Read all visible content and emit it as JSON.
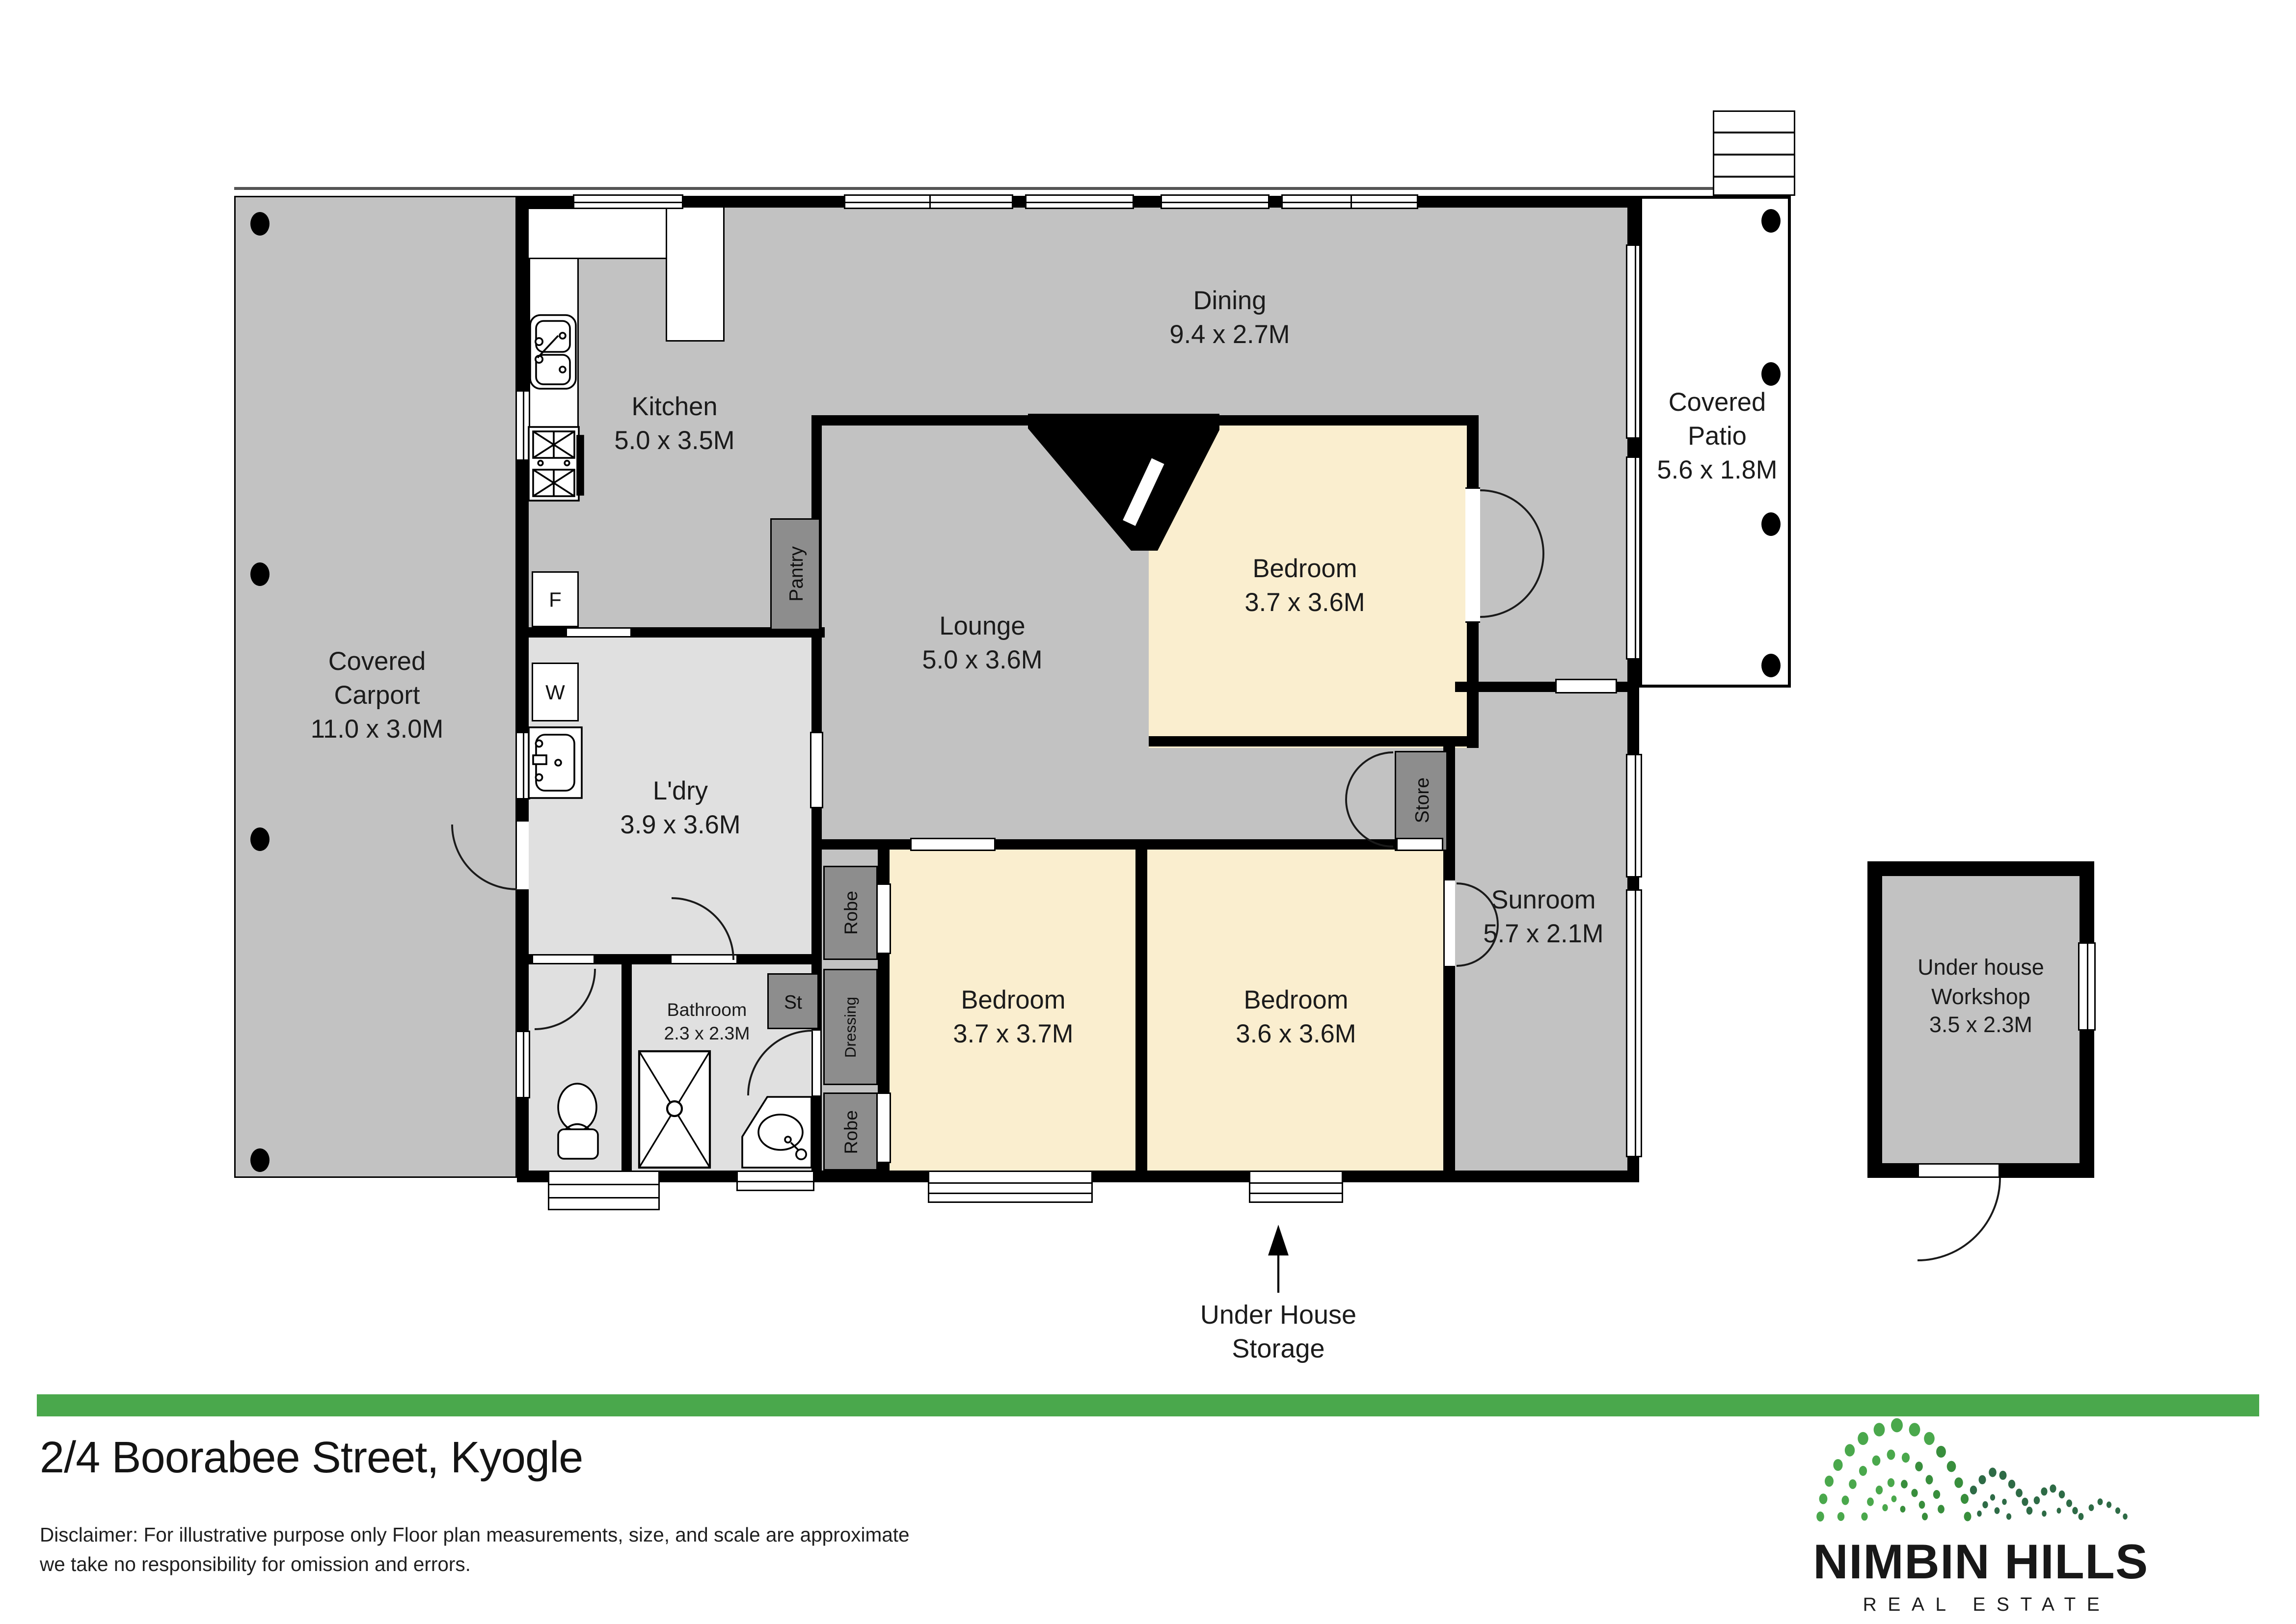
{
  "plan": {
    "rooms": {
      "carport": {
        "name": "Covered Carport",
        "dims": "11.0 x 3.0M"
      },
      "kitchen": {
        "name": "Kitchen",
        "dims": "5.0 x 3.5M"
      },
      "dining": {
        "name": "Dining",
        "dims": "9.4 x 2.7M"
      },
      "patio": {
        "name": "Covered Patio",
        "dims": "5.6 x 1.8M"
      },
      "lounge": {
        "name": "Lounge",
        "dims": "5.0 x 3.6M"
      },
      "bedroom1": {
        "name": "Bedroom",
        "dims": "3.7 x 3.6M"
      },
      "ldry": {
        "name": "L'dry",
        "dims": "3.9 x 3.6M"
      },
      "bathroom": {
        "name": "Bathroom",
        "dims": "2.3 x 2.3M"
      },
      "bedroom2": {
        "name": "Bedroom",
        "dims": "3.7 x 3.7M"
      },
      "bedroom3": {
        "name": "Bedroom",
        "dims": "3.6 x 3.6M"
      },
      "sunroom": {
        "name": "Sunroom",
        "dims": "5.7 x 2.1M"
      },
      "workshop": {
        "name": "Under house Workshop",
        "dims": "3.5 x 2.3M"
      },
      "storage": {
        "name": "Under House Storage"
      }
    },
    "fixtures": {
      "pantry": "Pantry",
      "robe_top": "Robe",
      "dressing": "Dressing",
      "robe_bottom": "Robe",
      "linen": "St",
      "store": "Store",
      "fridge": "F",
      "washer": "W"
    }
  },
  "footer": {
    "address": "2/4 Boorabee Street, Kyogle",
    "disclaimer_line1": "Disclaimer: For illustrative purpose only Floor plan measurements, size, and scale are approximate",
    "disclaimer_line2": "we take no responsibility for omission and errors.",
    "accent_color": "#4aa84c"
  },
  "logo": {
    "title": "NIMBIN HILLS",
    "subtitle": "REAL ESTATE",
    "greens": [
      "#4aa84c",
      "#388e3c",
      "#2e6b46"
    ]
  }
}
